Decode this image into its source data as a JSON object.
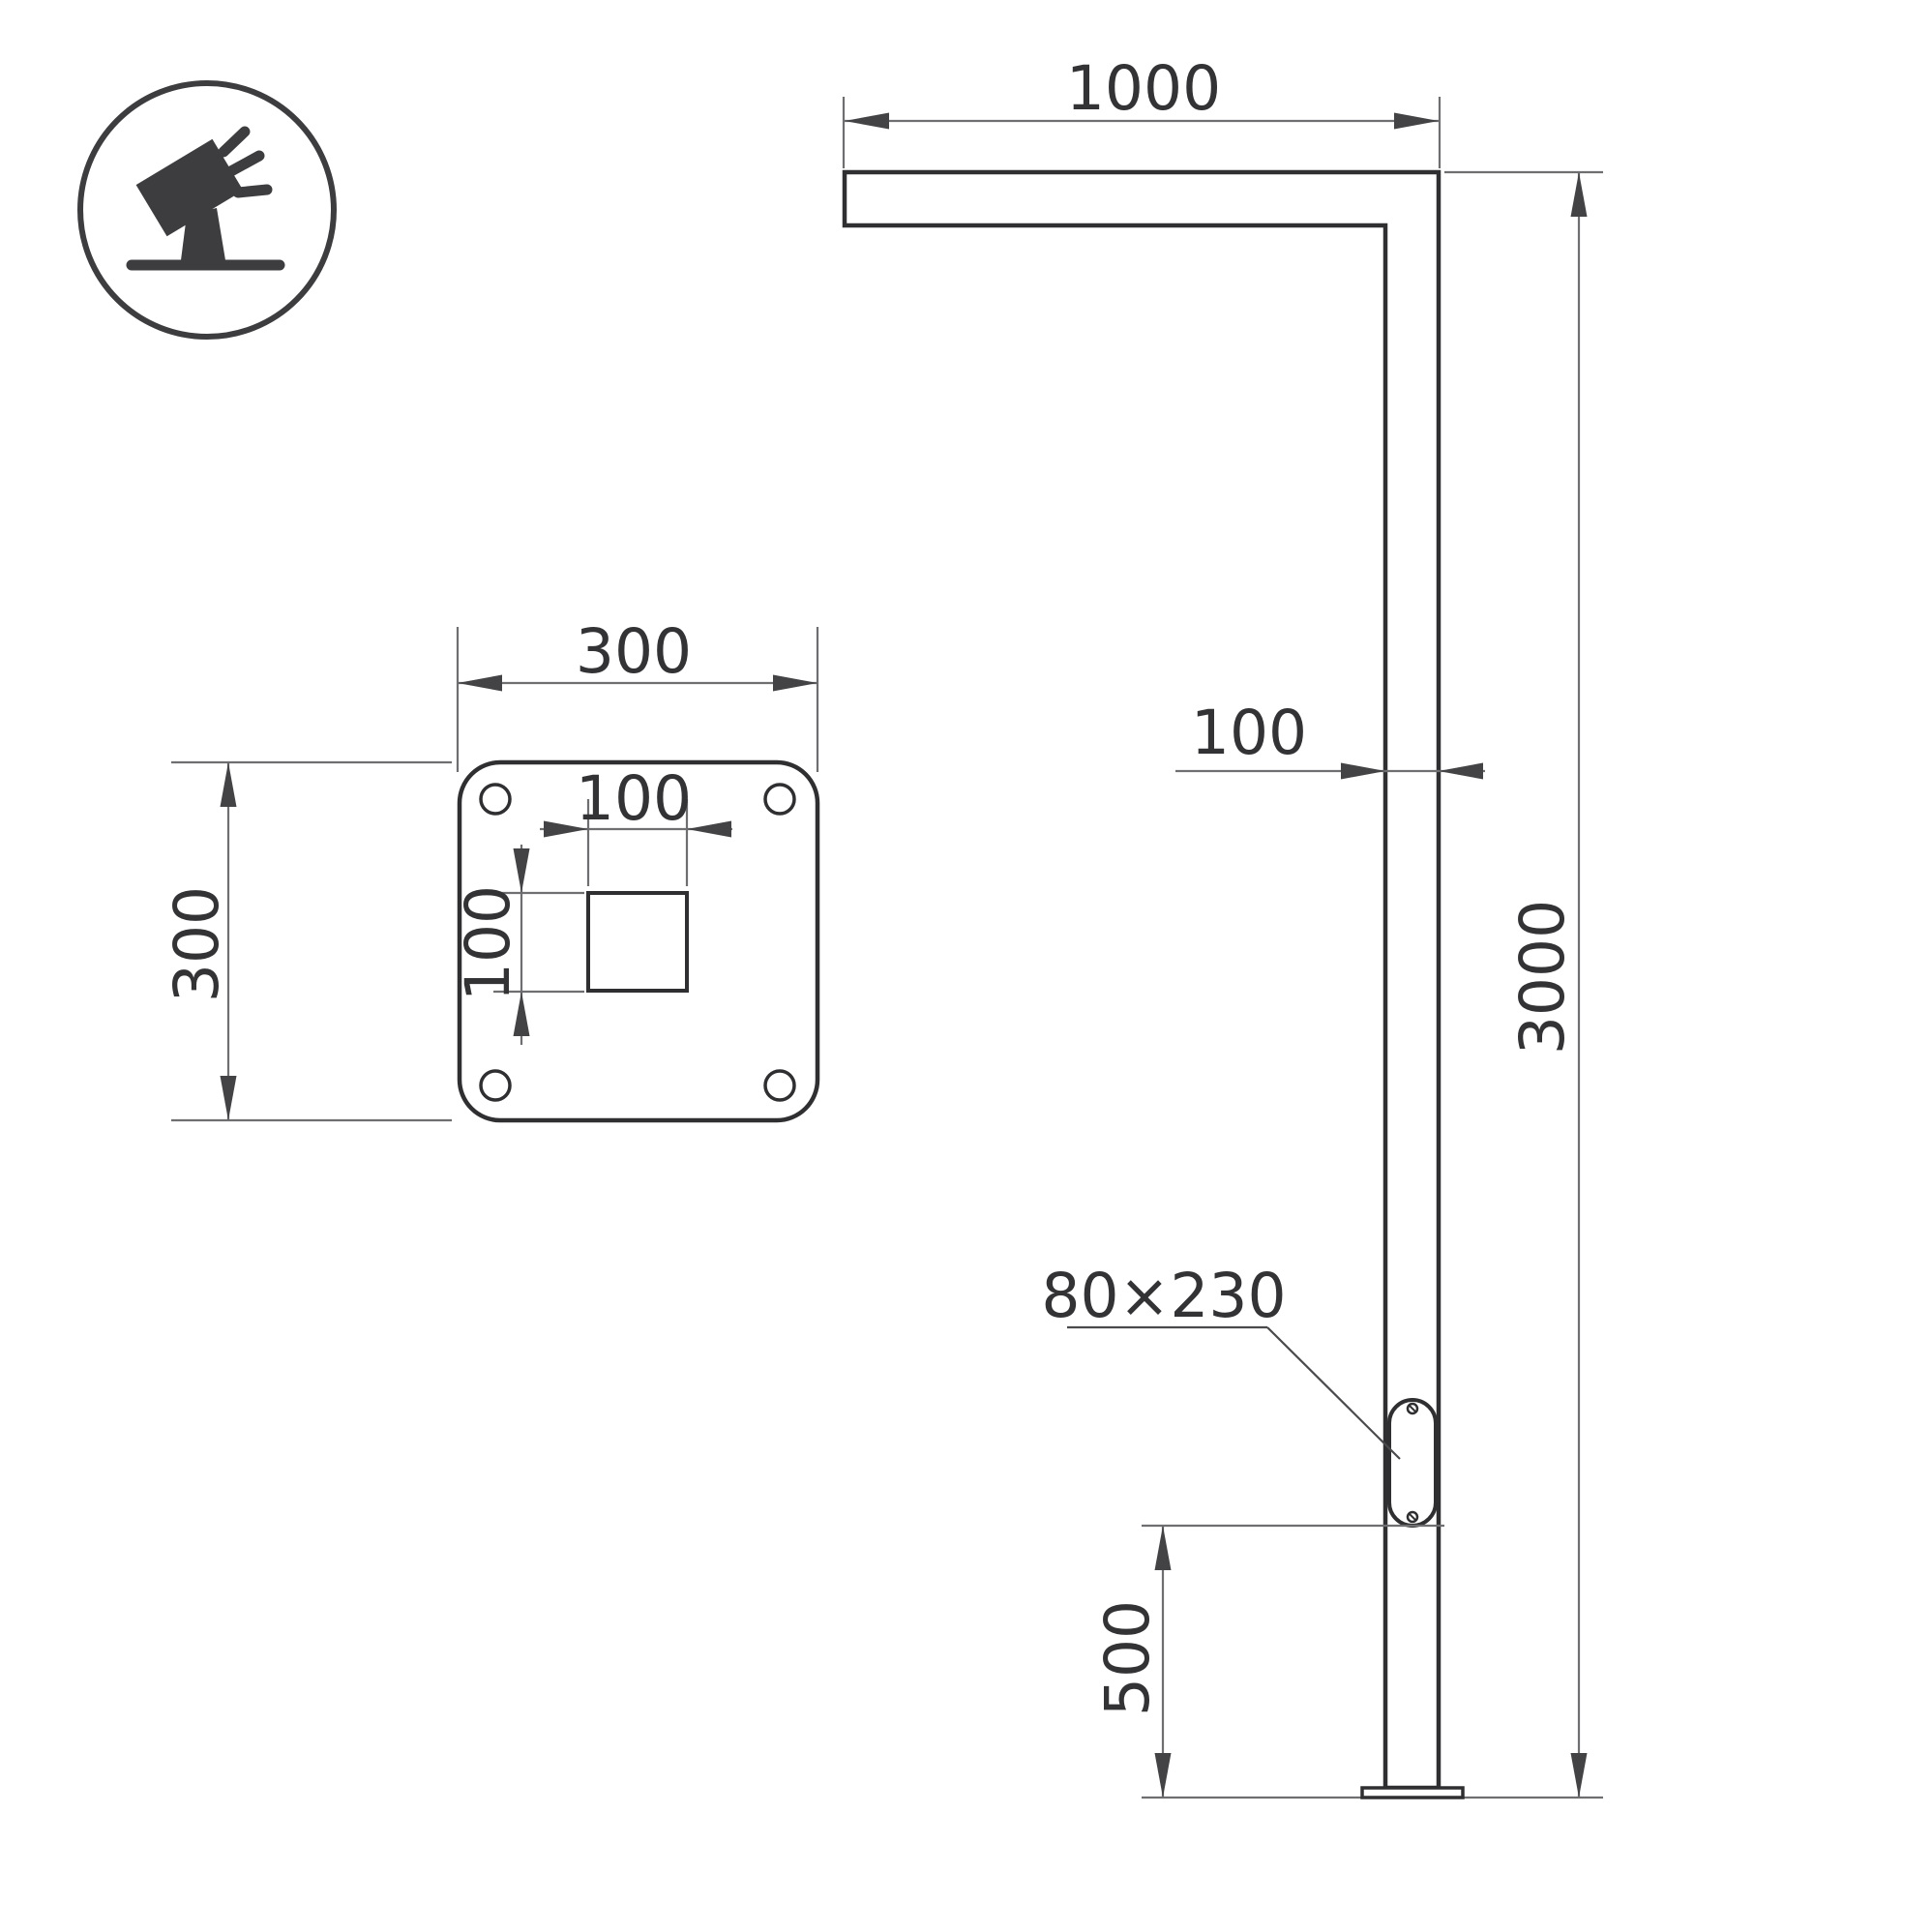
{
  "drawing": {
    "background": "#ffffff",
    "colors": {
      "object_line": "#2f2f31",
      "dimension_line": "#6f6f72",
      "arrowhead": "#434346",
      "text": "#333336",
      "icon": "#3d3d40"
    },
    "icon": {
      "name": "tilted-floodlight-on-stand-icon"
    },
    "plate_view": {
      "width": "300",
      "height": "300",
      "cutout_width": "100",
      "cutout_height": "100"
    },
    "elevation": {
      "arm_length": "1000",
      "pole_width": "100",
      "pole_height": "3000",
      "door_bottom_offset": "500",
      "door_size": "80×230"
    }
  }
}
